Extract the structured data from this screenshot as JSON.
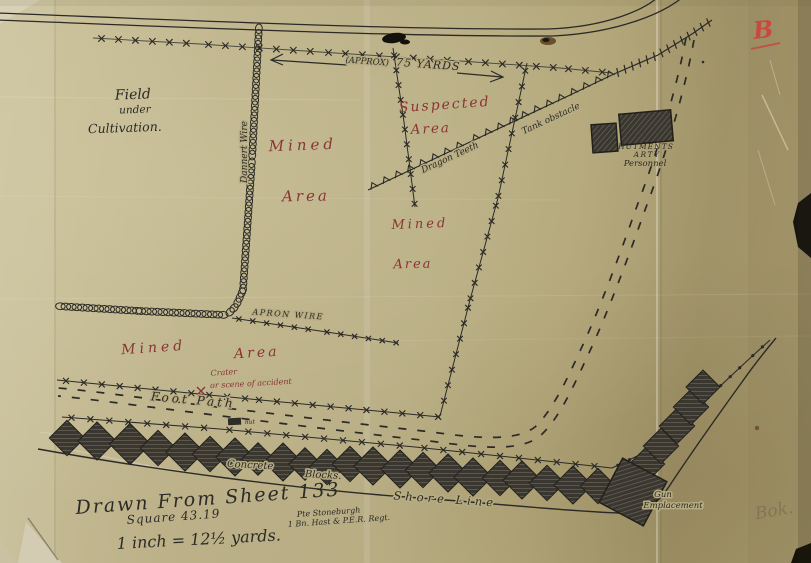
{
  "annotations": {
    "field": {
      "line1": "Field",
      "line2": "under",
      "line3": "Cultivation."
    },
    "mined_left": {
      "word1": "Mined",
      "word2": "Area"
    },
    "mined_mid": {
      "word1": "Mined",
      "word2": "Area"
    },
    "mined_bottom": {
      "word1": "Mined",
      "word2": "Area"
    },
    "suspected": {
      "line1": "Suspected",
      "line2": "Area"
    },
    "approx": {
      "prefix": "(APPROX)",
      "value": "75 YARDS"
    },
    "dragon_teeth": "Dragon Teeth",
    "tank_obstacle": "Tank obstacle",
    "hutments": {
      "line1": "HUTMENTS",
      "line2": "ARTY",
      "line3": "Personnel"
    },
    "dannert_wire": "Dannert Wire",
    "apron_wire": "APRON WIRE",
    "crater": {
      "line1": "Crater",
      "line2": "or scene of accident"
    },
    "foot_path": "Foot Path",
    "hut": "hut",
    "concrete": {
      "word1": "Concrete",
      "word2": "Blocks."
    },
    "shore_line": "Shore Line",
    "gun": {
      "line1": "Gun",
      "line2": "Emplacement"
    }
  },
  "title_block": {
    "drawn_from": "Drawn From Sheet 133",
    "square": "Square 43.19",
    "scale": "1 inch = 12½ yards.",
    "credit_line1": "Pte Stoneburgh",
    "credit_line2": "1 Bn. Hast & P.E.R. Regt."
  },
  "marginalia": {
    "red_letter": "B",
    "pencil_note": "Bok."
  },
  "colors": {
    "paper": "#b7ac82",
    "ink": "#2b2a26",
    "red_ink": "#8a3434",
    "red_pencil": "#c84a3e",
    "pencil_note": "#5f543f"
  }
}
